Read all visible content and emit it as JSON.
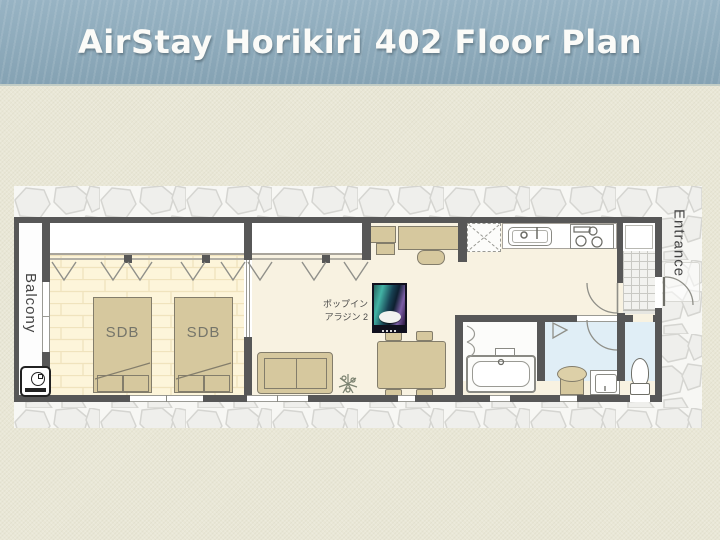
{
  "header": {
    "title": "AirStay Horikiri 402 Floor Plan"
  },
  "floor_plan": {
    "balcony_label": "Balcony",
    "entrance_label": "Entrance",
    "beds": [
      {
        "label": "SDB"
      },
      {
        "label": "SDB"
      }
    ],
    "projector": {
      "caption_line1": "ポップイン",
      "caption_line2": "アラジン 2"
    }
  },
  "icons": {
    "washing_machine": "washing-machine-icon",
    "curtain": "curtain-icon",
    "door_swing": "door-swing-icon",
    "sliding_door": "sliding-door-icon",
    "bathtub": "bathtub-icon",
    "toilet": "toilet-icon",
    "kitchen_sink": "kitchen-sink-icon",
    "stove": "stove-icon",
    "refrigerator_space": "refrigerator-space-icon",
    "shower": "shower-icon",
    "plant": "plant-icon",
    "sofa": "sofa-icon",
    "dining_table": "dining-table-icon",
    "bed": "bed-icon",
    "stool": "stool-icon",
    "washbasin": "washbasin-icon",
    "projector_photo": "projector-photo"
  },
  "colors": {
    "header_bg": "#8cabbd",
    "header_text": "#fbfbf8",
    "body_bg": "#e9e7d6",
    "wall": "#575757",
    "bedroom_floor": "#fdf5da",
    "living_floor": "#f8f2e1",
    "wet_area_floor": "#e0eef6",
    "furniture": "#d6c89e",
    "furniture_border": "#837d6b",
    "stone_fill": "#efefec",
    "stone_line": "#d5d5d1",
    "label_text": "#4a4a4a"
  }
}
